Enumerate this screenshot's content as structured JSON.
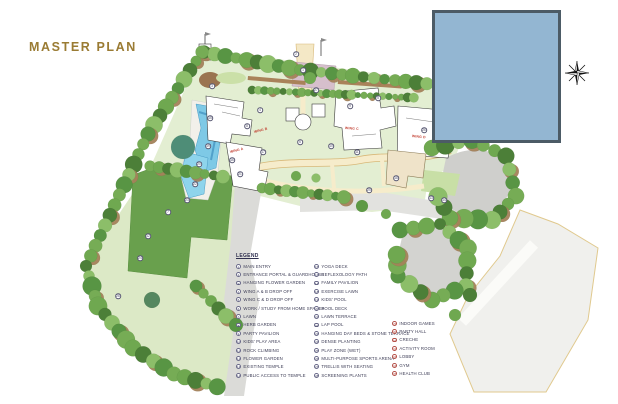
{
  "title": "MASTER PLAN",
  "colors": {
    "title_gold": "#9a7b33",
    "inset_blue": "#93b6d2",
    "inset_border": "#4c5b66",
    "lawn_green": "#69a04d",
    "pool_blue": "#7ec9e6",
    "path_cream": "#f6eccb",
    "legend_text": "#3c3c55",
    "legend_circle": "#6b6b8a",
    "legend_circle_amenity": "#b5524a",
    "wing_label_red": "#c0392b"
  },
  "legend": {
    "title": "LEGEND",
    "columns": [
      {
        "style": "default",
        "items": [
          {
            "n": "1",
            "label": "MAIN ENTRY"
          },
          {
            "n": "2",
            "label": "ENTRANCE PORTAL & GUARDHOUSE"
          },
          {
            "n": "3",
            "label": "HANGING FLOWER GARDEN"
          },
          {
            "n": "4",
            "label": "WING A & B DROP OFF"
          },
          {
            "n": "5",
            "label": "WING C & D DROP OFF"
          },
          {
            "n": "6",
            "label": "WORK / STUDY FROM HOME SPACES"
          },
          {
            "n": "7",
            "label": "LAWN"
          },
          {
            "n": "8",
            "label": "HERB GARDEN"
          },
          {
            "n": "9",
            "label": "PARTY PAVILION"
          },
          {
            "n": "10",
            "label": "KIDS' PLAY AREA"
          },
          {
            "n": "11",
            "label": "ROCK CLIMBING"
          },
          {
            "n": "12",
            "label": "FLOWER GARDEN"
          },
          {
            "n": "13",
            "label": "EXISTING TEMPLE"
          },
          {
            "n": "14",
            "label": "PUBLIC ACCESS TO TEMPLE"
          }
        ]
      },
      {
        "style": "default",
        "items": [
          {
            "n": "15",
            "label": "YOGA DECK"
          },
          {
            "n": "16",
            "label": "REFLEXOLOGY PATH"
          },
          {
            "n": "17",
            "label": "FAMILY PAVILION"
          },
          {
            "n": "18",
            "label": "EXERCISE LAWN"
          },
          {
            "n": "19",
            "label": "KIDS' POOL"
          },
          {
            "n": "20",
            "label": "POOL DECK"
          },
          {
            "n": "21",
            "label": "LAWN TERRACE"
          },
          {
            "n": "22",
            "label": "LAP POOL"
          },
          {
            "n": "23",
            "label": "HANGING DAY BEDS & STONE TERRACE"
          },
          {
            "n": "24",
            "label": "DENSE PLANTING"
          },
          {
            "n": "25",
            "label": "PLAY ZONE (WET)"
          },
          {
            "n": "26",
            "label": "MULTI-PURPOSE SPORTS ARENA"
          },
          {
            "n": "27",
            "label": "TRELLIS WITH SEATING"
          },
          {
            "n": "28",
            "label": "SCREENING PLANTS"
          }
        ]
      },
      {
        "style": "amenity",
        "items": [
          {
            "n": "29",
            "label": "INDOOR GAMES"
          },
          {
            "n": "30",
            "label": "PARTY HALL"
          },
          {
            "n": "31",
            "label": "CRECHE"
          },
          {
            "n": "32",
            "label": "ACTIVITY ROOM"
          },
          {
            "n": "33",
            "label": "LOBBY"
          },
          {
            "n": "34",
            "label": "GYM"
          },
          {
            "n": "35",
            "label": "HEALTH CLUB"
          }
        ]
      }
    ]
  },
  "plan": {
    "wing_labels": [
      {
        "text": "WING A",
        "x": 230,
        "y": 150,
        "rot": -14
      },
      {
        "text": "WING B",
        "x": 254,
        "y": 130,
        "rot": -14
      },
      {
        "text": "WING C",
        "x": 345,
        "y": 126,
        "rot": 4
      },
      {
        "text": "WING D",
        "x": 412,
        "y": 134,
        "rot": 6
      }
    ],
    "markers": [
      {
        "n": "1",
        "x": 303,
        "y": 70
      },
      {
        "n": "2",
        "x": 296,
        "y": 54
      },
      {
        "n": "3",
        "x": 212,
        "y": 86
      },
      {
        "n": "4",
        "x": 260,
        "y": 110
      },
      {
        "n": "5",
        "x": 378,
        "y": 98
      },
      {
        "n": "6",
        "x": 300,
        "y": 142
      },
      {
        "n": "7",
        "x": 168,
        "y": 212
      },
      {
        "n": "8",
        "x": 247,
        "y": 126
      },
      {
        "n": "9",
        "x": 350,
        "y": 106
      },
      {
        "n": "10",
        "x": 331,
        "y": 146
      },
      {
        "n": "11",
        "x": 357,
        "y": 152
      },
      {
        "n": "12",
        "x": 148,
        "y": 236
      },
      {
        "n": "13",
        "x": 431,
        "y": 198
      },
      {
        "n": "14",
        "x": 444,
        "y": 200
      },
      {
        "n": "15",
        "x": 210,
        "y": 118
      },
      {
        "n": "16",
        "x": 232,
        "y": 160
      },
      {
        "n": "17",
        "x": 263,
        "y": 152
      },
      {
        "n": "18",
        "x": 396,
        "y": 178
      },
      {
        "n": "19",
        "x": 208,
        "y": 146
      },
      {
        "n": "20",
        "x": 199,
        "y": 164
      },
      {
        "n": "21",
        "x": 240,
        "y": 174
      },
      {
        "n": "22",
        "x": 195,
        "y": 184
      },
      {
        "n": "23",
        "x": 187,
        "y": 200
      },
      {
        "n": "24",
        "x": 140,
        "y": 258
      },
      {
        "n": "25",
        "x": 369,
        "y": 190
      },
      {
        "n": "26",
        "x": 424,
        "y": 130
      },
      {
        "n": "27",
        "x": 316,
        "y": 90
      },
      {
        "n": "28",
        "x": 118,
        "y": 296
      }
    ]
  }
}
